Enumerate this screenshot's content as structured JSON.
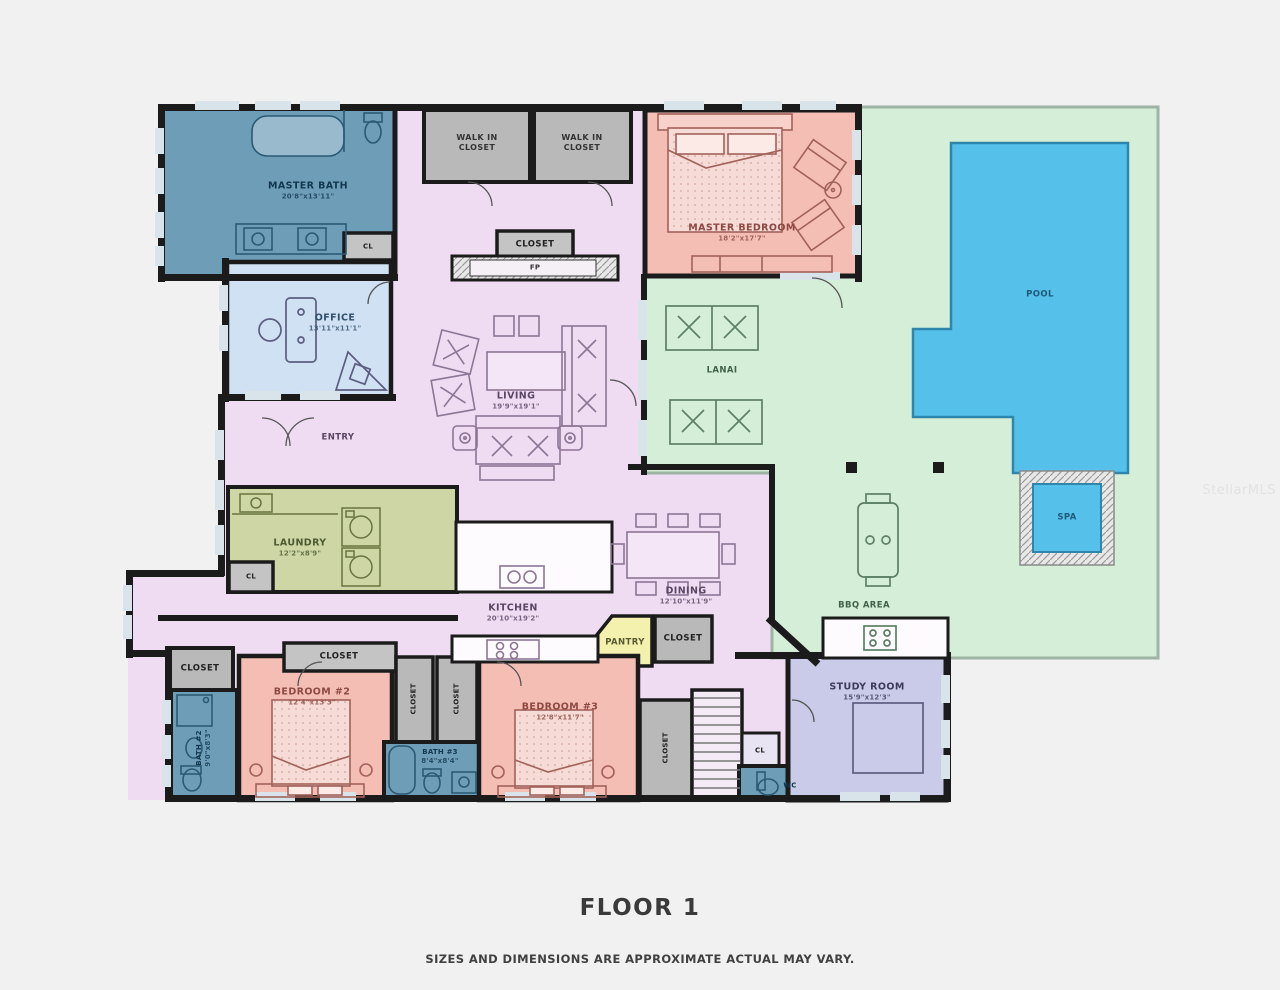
{
  "floor": {
    "title": "FLOOR 1",
    "disclaimer": "SIZES AND DIMENSIONS ARE APPROXIMATE ACTUAL MAY VARY.",
    "watermark": "StellarMLS"
  },
  "palette": {
    "background": "#f1f1f1",
    "wall": "#1b1b1b",
    "interior": "#efdcf2",
    "bedroom": "#f5beb5",
    "bath": "#6e9db8",
    "office": "#cfe1f3",
    "laundry": "#cdd6a4",
    "closet": "#b9b9b9",
    "pantry": "#f4f1af",
    "study": "#cacbe8",
    "lanai": "#d5eed7",
    "pool": "#55c0ea"
  },
  "rooms": {
    "master_bath": {
      "name": "MASTER BATH",
      "dims": "20'8\"x13'11\""
    },
    "walk_in_closet_1": {
      "name": "WALK IN CLOSET"
    },
    "walk_in_closet_2": {
      "name": "WALK IN CLOSET"
    },
    "master_bedroom": {
      "name": "MASTER BEDROOM",
      "dims": "18'2\"x17'7\""
    },
    "office": {
      "name": "OFFICE",
      "dims": "13'11\"x11'1\""
    },
    "living": {
      "name": "LIVING",
      "dims": "19'9\"x19'1\""
    },
    "entry": {
      "name": "ENTRY"
    },
    "closet_hall": {
      "name": "CLOSET"
    },
    "fireplace": {
      "name": "FP"
    },
    "cl_master_bath": {
      "name": "CL"
    },
    "laundry": {
      "name": "LAUNDRY",
      "dims": "12'2\"x8'9\""
    },
    "cl_laundry": {
      "name": "CL"
    },
    "kitchen": {
      "name": "KITCHEN",
      "dims": "20'10\"x19'2\""
    },
    "dining": {
      "name": "DINING",
      "dims": "12'10\"x11'9\""
    },
    "pantry": {
      "name": "PANTRY"
    },
    "closet_pantry": {
      "name": "CLOSET"
    },
    "lanai": {
      "name": "LANAI"
    },
    "bbq_area": {
      "name": "BBQ AREA"
    },
    "pool": {
      "name": "POOL"
    },
    "spa": {
      "name": "SPA"
    },
    "closet_hall_bl": {
      "name": "CLOSET"
    },
    "bath_2": {
      "name": "BATH #2",
      "dims": "9'0\"x8'3\""
    },
    "bedroom_2": {
      "name": "BEDROOM #2",
      "dims": "12'4\"x13'3\""
    },
    "closet_bedroom_2": {
      "name": "CLOSET"
    },
    "closet_hall_v1": {
      "name": "CLOSET"
    },
    "closet_hall_v2": {
      "name": "CLOSET"
    },
    "bath_3": {
      "name": "BATH #3",
      "dims": "8'4\"x8'4\""
    },
    "bedroom_3": {
      "name": "BEDROOM #3",
      "dims": "12'8\"x11'7\""
    },
    "closet_bedroom_3": {
      "name": "CLOSET"
    },
    "cl_stairs": {
      "name": "CL"
    },
    "wc": {
      "name": "WC"
    },
    "study_room": {
      "name": "STUDY ROOM",
      "dims": "15'9\"x12'3\""
    }
  }
}
